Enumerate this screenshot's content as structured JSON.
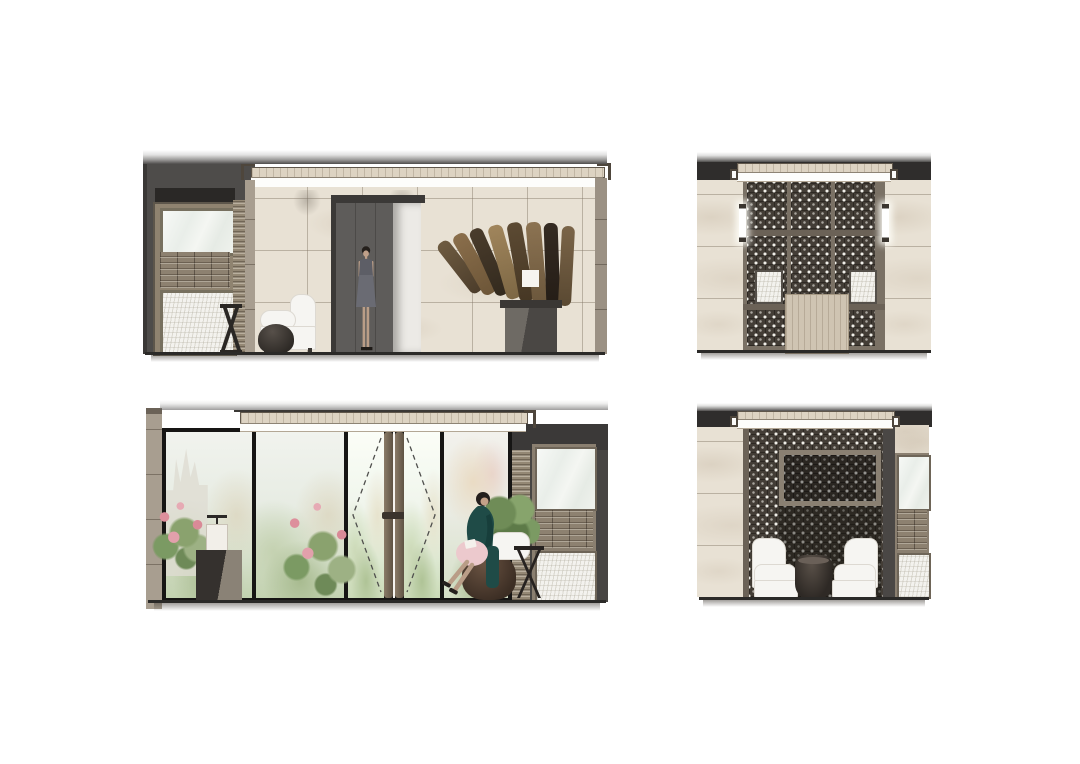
{
  "meta": {
    "document_type": "interior-elevation-rendering-sheet",
    "background": "#ffffff",
    "visible_text": "none"
  },
  "palette": {
    "marble_base": "#e8e1d4",
    "marble_joint": "#8c8070",
    "dark_wall": "#4e4c4a",
    "dark_band": "#2f2d2c",
    "taupe_frame": "#968a79",
    "taupe_dark": "#6b6257",
    "lattice_dark": "#433d36",
    "lattice_motif": "#f5f2ec",
    "cove_light": "#fdfdfb",
    "glass_tint": "#eef1ec",
    "foliage_green": "#9db184",
    "flower_pink": "#e2a0ab",
    "console_wood": "#cfc4b2",
    "dress_gray": "#63646c",
    "dress_teal": "#1f4b47",
    "pouf_brown": "#4a3a30",
    "chair_white": "#f7f6f4",
    "floor_line": "#2b2a28",
    "art_wood_browns": [
      "#6e5b41",
      "#8a6e4b",
      "#4a3c2c",
      "#a0855c",
      "#5c4a33",
      "#8c7352",
      "#352b22",
      "#7a6448"
    ]
  },
  "panels": [
    {
      "id": "elevation-top-left-entrance",
      "position": "top-left",
      "elements": [
        "cove-ceiling",
        "marble-wall",
        "millwork-unit",
        "woven-strip",
        "recessed-door",
        "standing-figure",
        "wood-art-installation",
        "stone-pedestal",
        "lounge-chair",
        "round-ottoman",
        "hourglass-side-table",
        "floor-line"
      ]
    },
    {
      "id": "elevation-top-right-screen-wall",
      "position": "top-right",
      "elements": [
        "cove-ceiling",
        "marble-side-walls",
        "lattice-screen-panels",
        "wall-sconces",
        "backlit-windows",
        "wood-console",
        "floor-line"
      ]
    },
    {
      "id": "elevation-bottom-left-glass-wall",
      "position": "bottom-left",
      "elements": [
        "stone-header",
        "marble-pilaster",
        "glass-panels",
        "garden-view",
        "double-door",
        "door-swing-dashes",
        "door-pulls",
        "flower-arrangements",
        "table-lamp",
        "stone-pedestal",
        "seated-figure",
        "ottoman-pouf",
        "x-base-side-table",
        "millwork-unit",
        "floor-line"
      ]
    },
    {
      "id": "elevation-bottom-right-lounge",
      "position": "bottom-right",
      "elements": [
        "cove-ceiling",
        "marble-wall",
        "lattice-screen-wall",
        "framed-lattice-panel",
        "armchair-pair",
        "drum-coffee-table",
        "millwork-column",
        "floor-line"
      ]
    }
  ]
}
